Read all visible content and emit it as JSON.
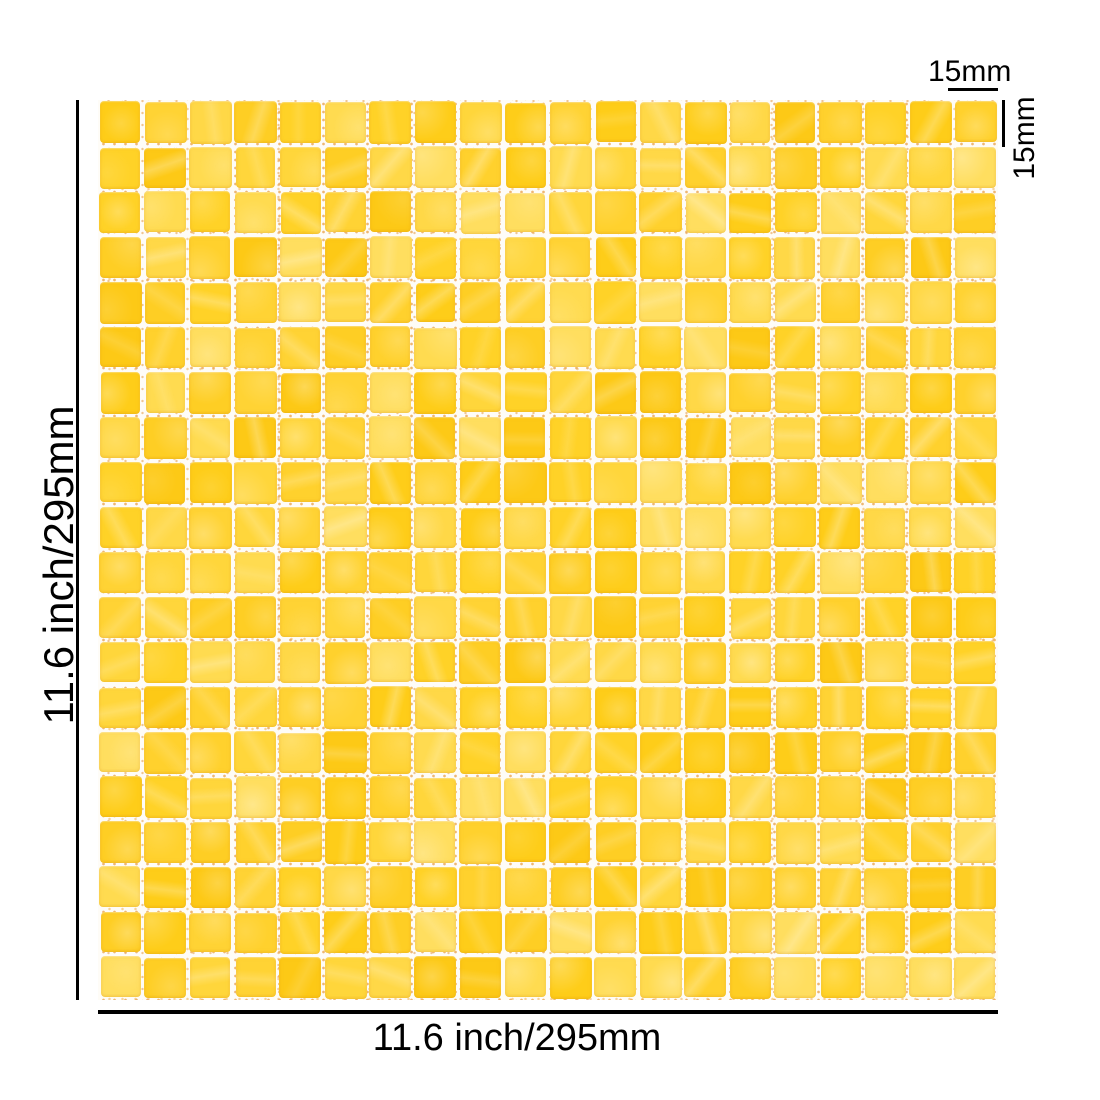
{
  "image": {
    "background_color": "#ffffff",
    "annotation_color": "#000000"
  },
  "annotations": {
    "sheet_height": {
      "label": "11.6 inch/295mm"
    },
    "sheet_width": {
      "label": "11.6 inch/295mm"
    },
    "tile_width": {
      "label": "15mm"
    },
    "tile_height": {
      "label": "15mm"
    }
  },
  "mosaic": {
    "rows": 20,
    "cols": 20,
    "seed": 1337,
    "grout_color": "#fefcf7",
    "speckle_colors": [
      "#eaa95c",
      "#f5cd92"
    ],
    "tile_palette": [
      "#ffd227",
      "#fecd19",
      "#ffd63b",
      "#ffdb50",
      "#fdc916",
      "#ffd334",
      "#ffd847",
      "#fece24",
      "#ffd12d",
      "#ffde5f"
    ]
  }
}
